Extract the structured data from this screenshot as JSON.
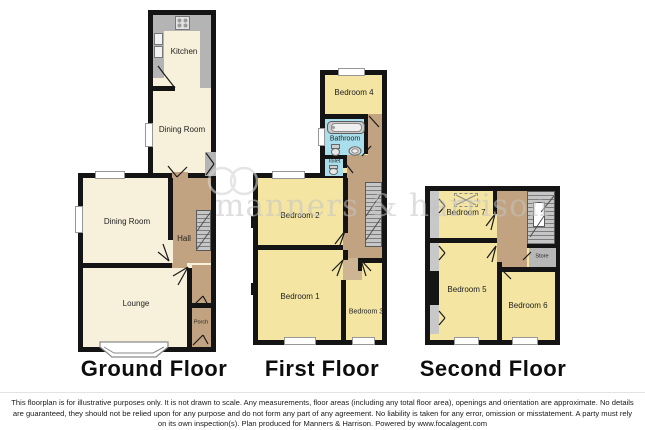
{
  "watermark": {
    "text": "manners & harrison"
  },
  "floors": {
    "ground": {
      "label": "Ground Floor",
      "rooms": {
        "kitchen": "Kitchen",
        "dining_upper": "Dining Room",
        "dining_lower": "Dining Room",
        "hall": "Hall",
        "lounge": "Lounge",
        "porch": "Porch"
      }
    },
    "first": {
      "label": "First Floor",
      "rooms": {
        "bedroom4": "Bedroom 4",
        "bathroom": "Bathroom",
        "toilet": "Toilet",
        "bedroom2": "Bedroom 2",
        "bedroom1": "Bedroom 1",
        "bedroom3": "Bedroom 3"
      }
    },
    "second": {
      "label": "Second Floor",
      "rooms": {
        "bedroom7": "Bedroom 7",
        "bedroom5": "Bedroom 5",
        "bedroom6": "Bedroom 6",
        "store": "Store"
      }
    }
  },
  "disclaimer": "This floorplan is for illustrative purposes only. It is not drawn to scale. Any measurements, floor areas (including any total floor area), openings and orientation are approximate. No details are guaranteed, they should not be relied upon for any purpose and do not form any part of any agreement. No liability is taken for any error, omission or misstatement. A party must rely on its own inspection(s). Plan produced for Manners & Harrison. Powered by www.focalagent.com",
  "colors": {
    "wall": "#141414",
    "room_cream": "#f7f0da",
    "room_yellow": "#f4e5a3",
    "hall_brown": "#c2a381",
    "landing_light": "#cdb493",
    "bath_blue": "#a9dfec",
    "counter_gray": "#b4b4b4",
    "stairs_gray": "#c6c6c6",
    "eaves_gray": "#c8c8c8",
    "store_gray": "#b7b7b7",
    "watermark_gray": "#c4c4c4"
  }
}
